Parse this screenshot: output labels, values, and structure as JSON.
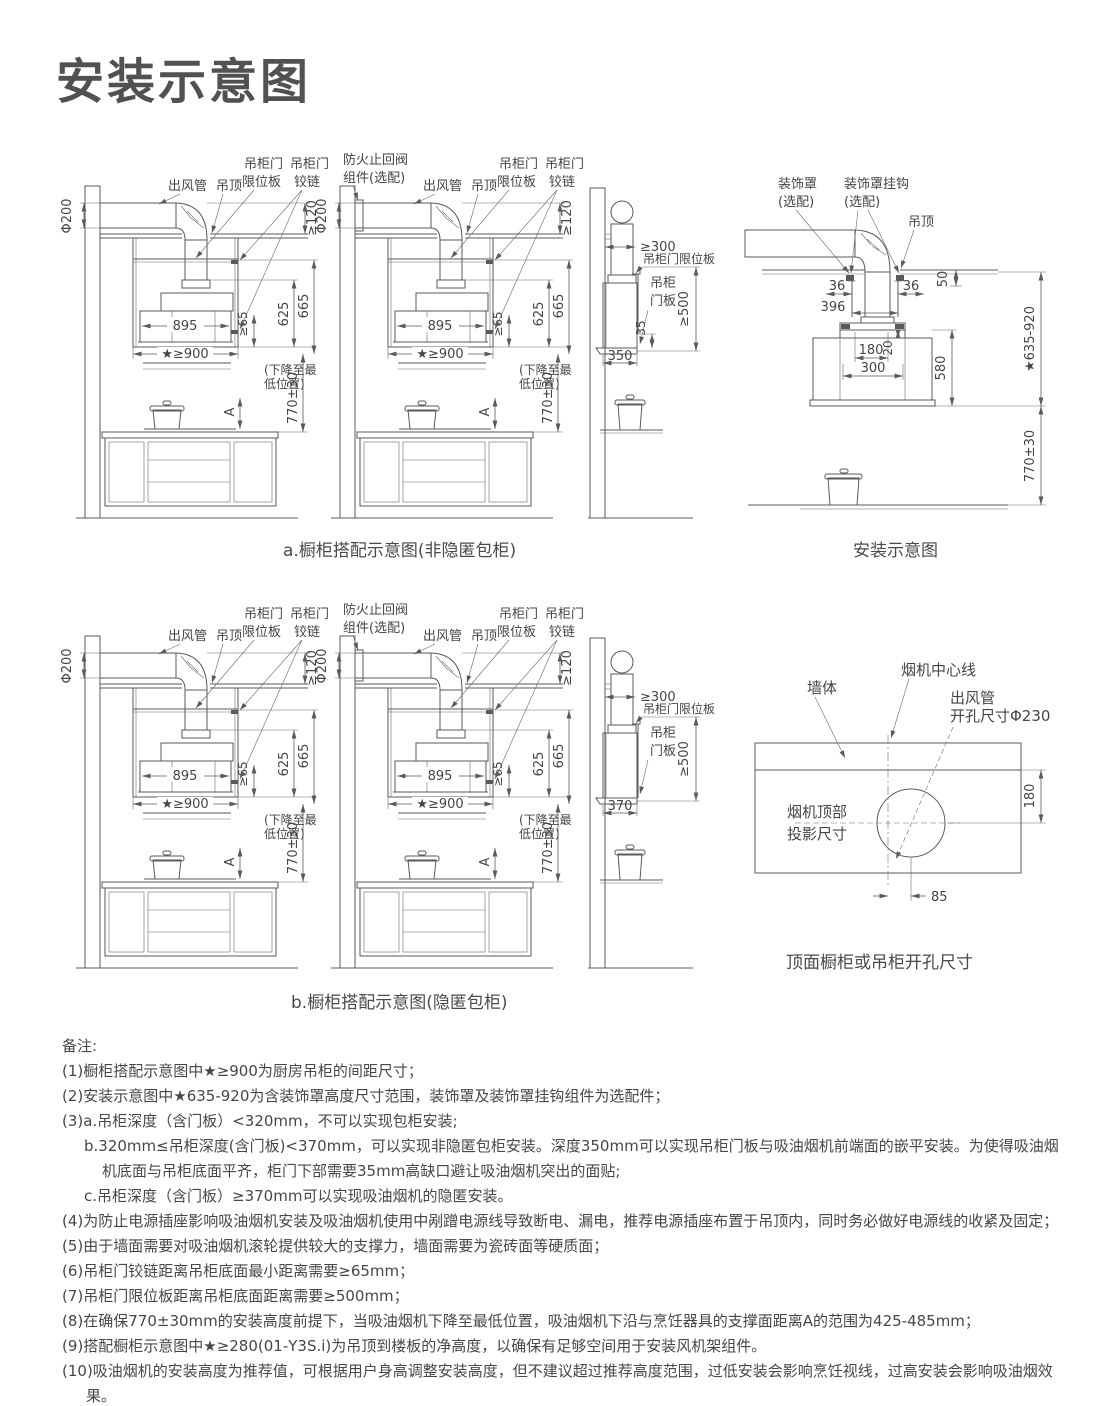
{
  "title": "安装示意图",
  "captions": {
    "row_a": "a.橱柜搭配示意图(非隐匿包柜)",
    "install": "安装示意图",
    "row_b": "b.橱柜搭配示意图(隐匿包柜)",
    "hole": "顶面橱柜或吊柜开孔尺寸"
  },
  "cabinet": {
    "duct": "出风管",
    "ceiling": "吊顶",
    "limit1": "吊柜门",
    "limit2": "限位板",
    "hinge1": "吊柜门",
    "hinge2": "铰链",
    "valve1": "防火止回阀",
    "valve2": "组件(选配)",
    "phi200": "Φ200",
    "ge120": "≥120",
    "w895": "895",
    "ge65": "≥65",
    "h625": "625",
    "h665": "665",
    "ge900": "★≥900",
    "drop1": "(下降至最",
    "drop2": "低位置)",
    "h770": "770±30",
    "a": "A"
  },
  "side": {
    "ge300": "≥300",
    "limit": "吊柜门限位板",
    "door1": "吊柜",
    "door2": "门板",
    "ge500": "≥500",
    "d350": "350",
    "n35": "35",
    "d370": "370"
  },
  "install": {
    "cover1": "装饰罩",
    "cover2": "(选配)",
    "hook1": "装饰罩挂钩",
    "hook2": "(选配)",
    "ceiling": "吊顶",
    "d36l": "36",
    "d36r": "36",
    "d396": "396",
    "d50": "50",
    "d180": "180",
    "d20": "20",
    "d300": "300",
    "d580": "580",
    "range": "★635-920",
    "h770": "770±30"
  },
  "hole": {
    "wall": "墙体",
    "center": "烟机中心线",
    "duct1": "出风管",
    "duct2": "开孔尺寸Φ230",
    "proj1": "烟机顶部",
    "proj2": "投影尺寸",
    "d180": "180",
    "d85": "85"
  },
  "notes": {
    "title": "备注:",
    "items": [
      "(1)橱柜搭配示意图中★≥900为厨房吊柜的间距尺寸；",
      "(2)安装示意图中★635-920为含装饰罩高度尺寸范围，装饰罩及装饰罩挂钩组件为选配件；",
      "(3)a.吊柜深度（含门板）<320mm，不可以实现包柜安装;",
      "b.320mm≤吊柜深度(含门板)<370mm，可以实现非隐匿包柜安装。深度350mm可以实现吊柜门板与吸油烟机前端面的嵌平安装。为使得吸油烟机底面与吊柜底面平齐，柜门下部需要35mm高缺口避让吸油烟机突出的面贴;",
      "c.吊柜深度（含门板）≥370mm可以实现吸油烟机的隐匿安装。",
      "(4)为防止电源插座影响吸油烟机安装及吸油烟机使用中剐蹭电源线导致断电、漏电，推荐电源插座布置于吊顶内，同时务必做好电源线的收紧及固定；",
      "(5)由于墙面需要对吸油烟机滚轮提供较大的支撑力，墙面需要为瓷砖面等硬质面；",
      "(6)吊柜门铰链距离吊柜底面最小距离需要≥65mm；",
      "(7)吊柜门限位板距离吊柜底面距离需要≥500mm；",
      "(8)在确保770±30mm的安装高度前提下，当吸油烟机下降至最低位置，吸油烟机下沿与烹饪器具的支撑面距离A的范围为425-485mm；",
      "(9)搭配橱柜示意图中★≥280(01-Y3S.i)为吊顶到楼板的净高度，以确保有足够空间用于安装风机架组件。",
      "(10)吸油烟机的安装高度为推荐值，可根据用户身高调整安装高度，但不建议超过推荐高度范围，过低安装会影响烹饪视线，过高安装会影响吸油烟效果。",
      "(11)为提升安装便捷性，本产品烟管因升级存在随机发货的情况（主要差异为烟道开孔与烟管尺寸），具体以您收到的产品说明书为准。请您放心，本次升级不影响安装效果或产品体验效果，您可放心选购！"
    ]
  }
}
